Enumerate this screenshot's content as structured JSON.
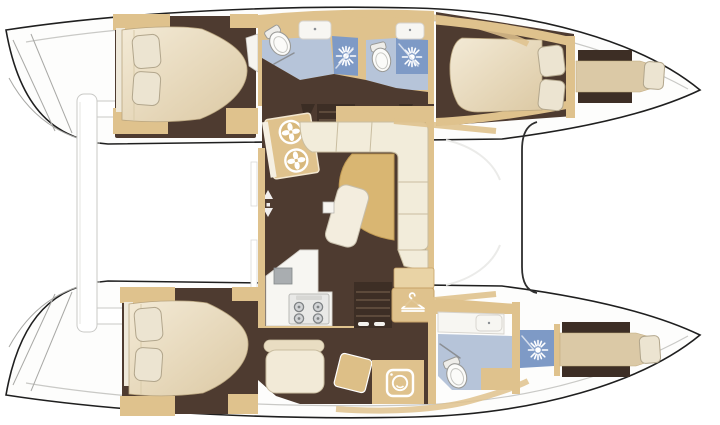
{
  "meta": {
    "type": "floor-plan",
    "subject": "catamaran-interior-layout",
    "orientation": "bow-right",
    "visible_text": ""
  },
  "colors": {
    "background": "#ffffff",
    "outline": "#1f1f1f",
    "hull-fill": "#fdfdfc",
    "deck-line": "#c9c9c6",
    "floor": "#4e3b30",
    "floor-dark": "#3d2e25",
    "step-line": "#5d4a3b",
    "wood": "#dfc28d",
    "wood-dark": "#c7a267",
    "wood-light": "#e9d3a5",
    "cream": "#f2ecda",
    "cream-line": "#c9bda0",
    "mattress-1": "#f1e7d0",
    "mattress-2": "#d9c6a1",
    "pillow": "#ece4d1",
    "pillow-line": "#b2a68c",
    "bath-blue": "#b6c4d9",
    "shower-blue": "#7e9ac6",
    "glass-line": "#8b8f94",
    "white-surface": "#f7f6f2",
    "white-line": "#d6d3cd",
    "appliance-gray": "#a9adb0",
    "stove-panel": "#e9e9e7",
    "burner-gray": "#d2d4d6",
    "burner-ring": "#808486",
    "icon-white": "#ffffff",
    "table-wood": "#d9b672",
    "berth-tan": "#dbc9a6"
  },
  "icons": {
    "shower": "sun-burst-showerhead",
    "hanger": "clothes-hanger",
    "washer": "washing-machine",
    "galley_sinks": "twin-round-sinks",
    "stove": "four-burner-stove",
    "companionway": "up-down-arrows",
    "toilet": "toilet-bowl",
    "basin": "rectangular-sink"
  },
  "rooms": [
    {
      "id": "aft-cabin-port",
      "feature": "double-berth-two-pillows"
    },
    {
      "id": "aft-head-port",
      "feature": "toilet-sink-shower"
    },
    {
      "id": "forward-head-port",
      "feature": "toilet-sink-shower"
    },
    {
      "id": "forward-cabin-port",
      "feature": "double-berth-two-pillows"
    },
    {
      "id": "forepeak-port",
      "feature": "single-berth-pillow"
    },
    {
      "id": "saloon",
      "feature": "l-sofa-table-nav-sinks-galley-stove-stairs"
    },
    {
      "id": "aft-cabin-starboard",
      "feature": "double-berth-two-pillows"
    },
    {
      "id": "dressing-area-starboard",
      "feature": "seat-stool-desk-washing-machine-hanging-locker"
    },
    {
      "id": "forward-head-starboard",
      "feature": "toilet-sink-shower"
    },
    {
      "id": "forepeak-starboard",
      "feature": "single-berth-pillow"
    }
  ]
}
